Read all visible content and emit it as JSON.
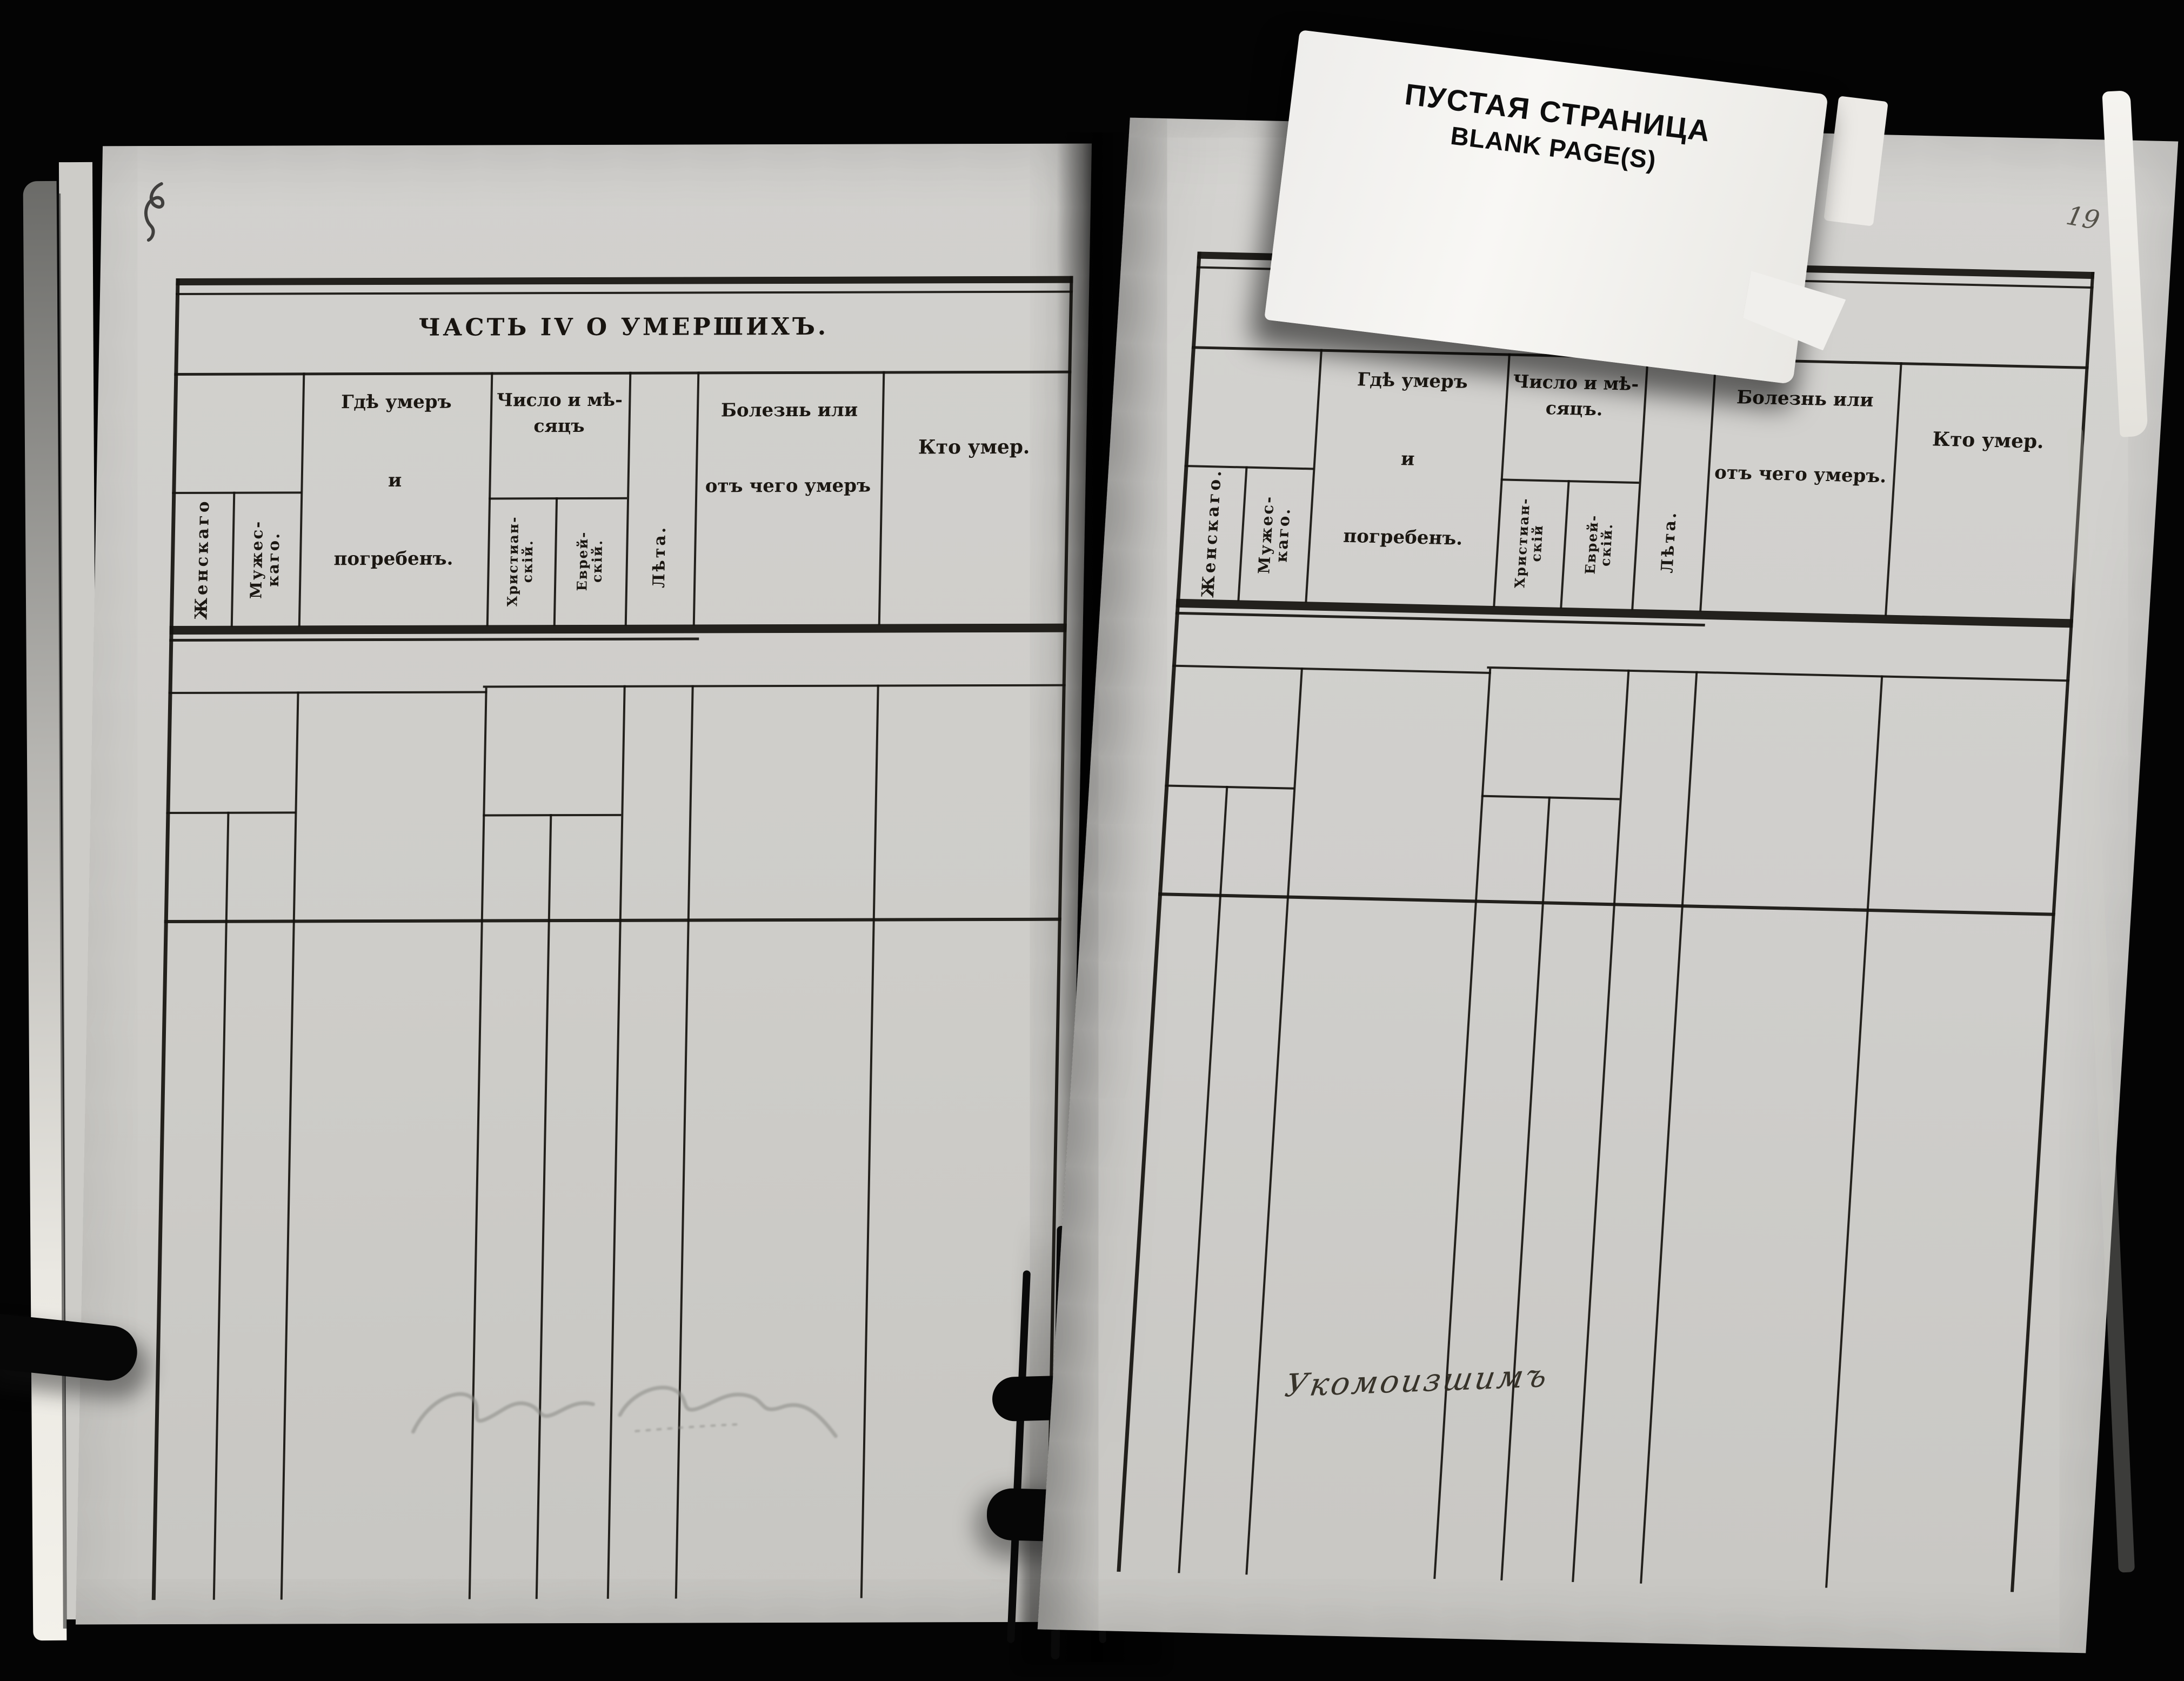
{
  "card": {
    "line_ru": "ПУСТАЯ СТРАНИЦА",
    "line_en": "BLANK PAGE(S)"
  },
  "left_page": {
    "title": "ЧАСТЬ IV О УМЕРШИХЪ.",
    "headers": {
      "female": "Женскаго",
      "male": [
        "Мужес-",
        "каго."
      ],
      "where": [
        "Гдѣ умеръ",
        "и",
        "погребенъ."
      ],
      "date_group": [
        "Число и мѣ-",
        "сяцъ"
      ],
      "christian": [
        "Христиан-",
        "скій."
      ],
      "jewish": [
        "Еврей-",
        "скій."
      ],
      "age": "Лѣта.",
      "illness": [
        "Болезнь или",
        "отъ чего умеръ"
      ],
      "who": "Кто умер."
    }
  },
  "right_page": {
    "headers": {
      "female": "Женскаго.",
      "male": [
        "Мужес-",
        "каго."
      ],
      "where": [
        "Гдѣ умеръ",
        "и",
        "погребенъ."
      ],
      "date_group": [
        "Число и мѣ-",
        "сяцъ."
      ],
      "christian": [
        "Христиан-",
        "скій"
      ],
      "jewish": [
        "Еврей-",
        "скій."
      ],
      "age": "Лѣта.",
      "illness": [
        "Болезнь или",
        "отъ чего умеръ."
      ],
      "who": "Кто умер."
    },
    "handwriting": "Укомоизшимъ",
    "page_number": "19"
  }
}
